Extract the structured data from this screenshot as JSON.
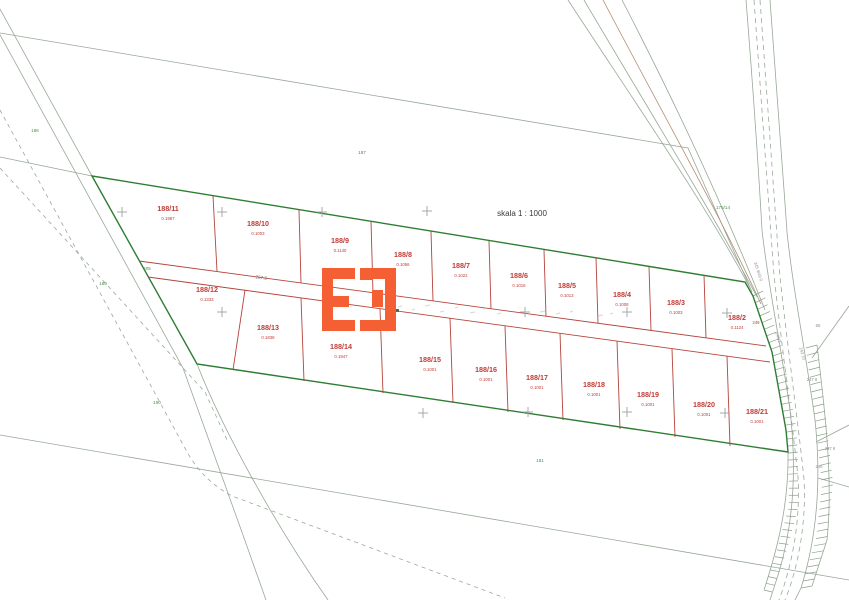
{
  "map": {
    "scale_label": {
      "text": "skala 1 : 1000",
      "x": 522,
      "y": 216
    },
    "measurement": {
      "text": "257.3",
      "x": 261,
      "y": 279,
      "rotate": 8
    },
    "parcels": [
      {
        "id": "188/11",
        "area": "0.1987",
        "x": 168,
        "y": 211
      },
      {
        "id": "188/10",
        "area": "0.1003",
        "x": 258,
        "y": 226
      },
      {
        "id": "188/9",
        "area": "0.1140",
        "x": 340,
        "y": 243
      },
      {
        "id": "188/8",
        "area": "0.1056",
        "x": 403,
        "y": 257
      },
      {
        "id": "188/7",
        "area": "0.1022",
        "x": 461,
        "y": 268
      },
      {
        "id": "188/6",
        "area": "0.1016",
        "x": 519,
        "y": 278
      },
      {
        "id": "188/5",
        "area": "0.1013",
        "x": 567,
        "y": 288
      },
      {
        "id": "188/4",
        "area": "0.1008",
        "x": 622,
        "y": 297
      },
      {
        "id": "188/3",
        "area": "0.1003",
        "x": 676,
        "y": 305
      },
      {
        "id": "188/2",
        "area": "0.1124",
        "x": 737,
        "y": 320
      },
      {
        "id": "188/12",
        "area": "0.1333",
        "x": 207,
        "y": 292
      },
      {
        "id": "188/13",
        "area": "0.1838",
        "x": 268,
        "y": 330
      },
      {
        "id": "188/14",
        "area": "0.1947",
        "x": 341,
        "y": 349
      },
      {
        "id": "188/15",
        "area": "0.1001",
        "x": 430,
        "y": 362
      },
      {
        "id": "188/16",
        "area": "0.1001",
        "x": 486,
        "y": 372
      },
      {
        "id": "188/17",
        "area": "0.1001",
        "x": 537,
        "y": 380
      },
      {
        "id": "188/18",
        "area": "0.1001",
        "x": 594,
        "y": 387
      },
      {
        "id": "188/19",
        "area": "0.1001",
        "x": 648,
        "y": 397
      },
      {
        "id": "188/20",
        "area": "0.1001",
        "x": 704,
        "y": 407
      },
      {
        "id": "188/21",
        "area": "0.1001",
        "x": 757,
        "y": 414
      }
    ],
    "neighbor_labels": [
      {
        "text": "186",
        "x": 35,
        "y": 132
      },
      {
        "text": "187",
        "x": 362,
        "y": 154
      },
      {
        "text": "189",
        "x": 103,
        "y": 285
      },
      {
        "text": "190",
        "x": 157,
        "y": 404
      },
      {
        "text": "181",
        "x": 540,
        "y": 462
      },
      {
        "text": "505",
        "x": 147,
        "y": 270
      },
      {
        "text": "175/14",
        "x": 723,
        "y": 209
      }
    ],
    "survey_labels": [
      {
        "text": "245 9/49 0",
        "x": 757,
        "y": 272,
        "rotate": 72
      },
      {
        "text": "249",
        "x": 756,
        "y": 324,
        "color": "#c0392b"
      },
      {
        "text": "65",
        "x": 818,
        "y": 327
      },
      {
        "text": "246/2",
        "x": 777,
        "y": 338,
        "rotate": 72
      },
      {
        "text": "243 10",
        "x": 801,
        "y": 354,
        "rotate": 75
      },
      {
        "text": "247 8",
        "x": 812,
        "y": 381
      },
      {
        "text": "247 9",
        "x": 830,
        "y": 450
      },
      {
        "text": "249",
        "x": 819,
        "y": 468
      }
    ],
    "crosses": [
      [
        122,
        212
      ],
      [
        222,
        212
      ],
      [
        322,
        212
      ],
      [
        427,
        211
      ],
      [
        222,
        312
      ],
      [
        525,
        312
      ],
      [
        627,
        312
      ],
      [
        727,
        313
      ],
      [
        423,
        413
      ],
      [
        528,
        412
      ],
      [
        627,
        412
      ],
      [
        725,
        413
      ]
    ],
    "colors": {
      "parcel_line": "#b5443c",
      "parcel_text": "#c13b36",
      "boundary_green": "#2e7d32",
      "thin_line": "#97a897",
      "dashed_line": "#9aa89c",
      "survey_gray": "#8f8f8f",
      "neighbor_green": "#4c8f4c",
      "cross_gray": "#a9a9a9",
      "logo_orange": "#f45f33",
      "brown_line": "#b58d74",
      "scale_text": "#3a3a3a"
    }
  }
}
